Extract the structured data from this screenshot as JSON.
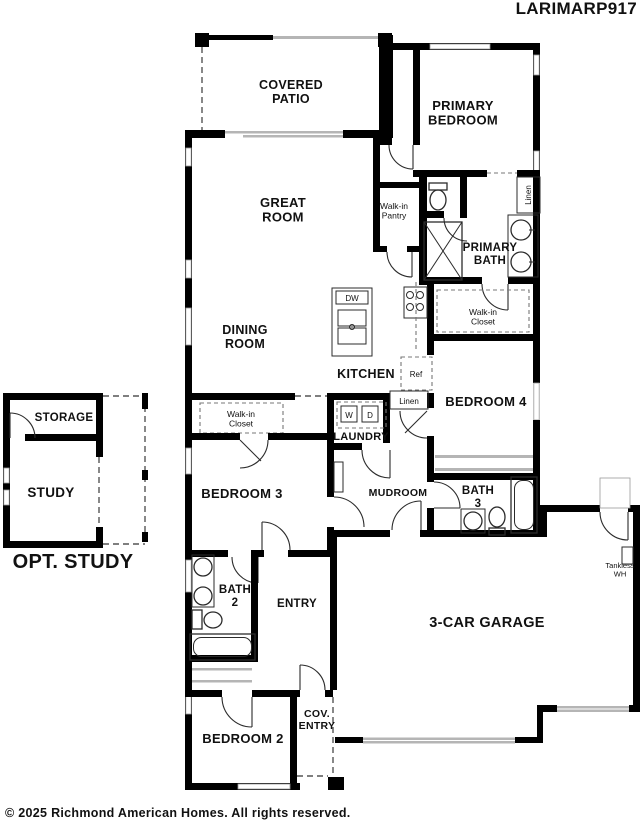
{
  "meta": {
    "title": "LARIMARP917",
    "copyright": "© 2025 Richmond American Homes. All rights reserved."
  },
  "rooms": {
    "covered_patio": "COVERED\nPATIO",
    "primary_bedroom": "PRIMARY\nBEDROOM",
    "great_room": "GREAT\nROOM",
    "walk_in_pantry": "Walk-in\nPantry",
    "primary_bath": "PRIMARY\nBATH",
    "walk_in_closet_primary": "Walk-in\nCloset",
    "dining_room": "DINING\nROOM",
    "kitchen": "KITCHEN",
    "bedroom_4": "BEDROOM 4",
    "laundry": "LAUNDRY",
    "mudroom": "MUDROOM",
    "bath_3": "BATH\n3",
    "bedroom_3": "BEDROOM 3",
    "walk_in_closet_bedroom3": "Walk-in\nCloset",
    "bath_2": "BATH\n2",
    "entry": "ENTRY",
    "bedroom_2": "BEDROOM 2",
    "cov_entry": "COV.\nENTRY",
    "garage": "3-CAR GARAGE",
    "storage": "STORAGE",
    "study": "STUDY",
    "opt_study": "OPT. STUDY"
  },
  "fixtures": {
    "dishwasher": "DW",
    "refrigerator": "Ref",
    "washer": "W",
    "dryer": "D",
    "linen_hall": "Linen",
    "linen_bath": "Linen",
    "tankless_wh": "Tankless\nWH"
  },
  "colors": {
    "wall": "#000000",
    "window": "#b5b5b5",
    "text": "#111111"
  }
}
